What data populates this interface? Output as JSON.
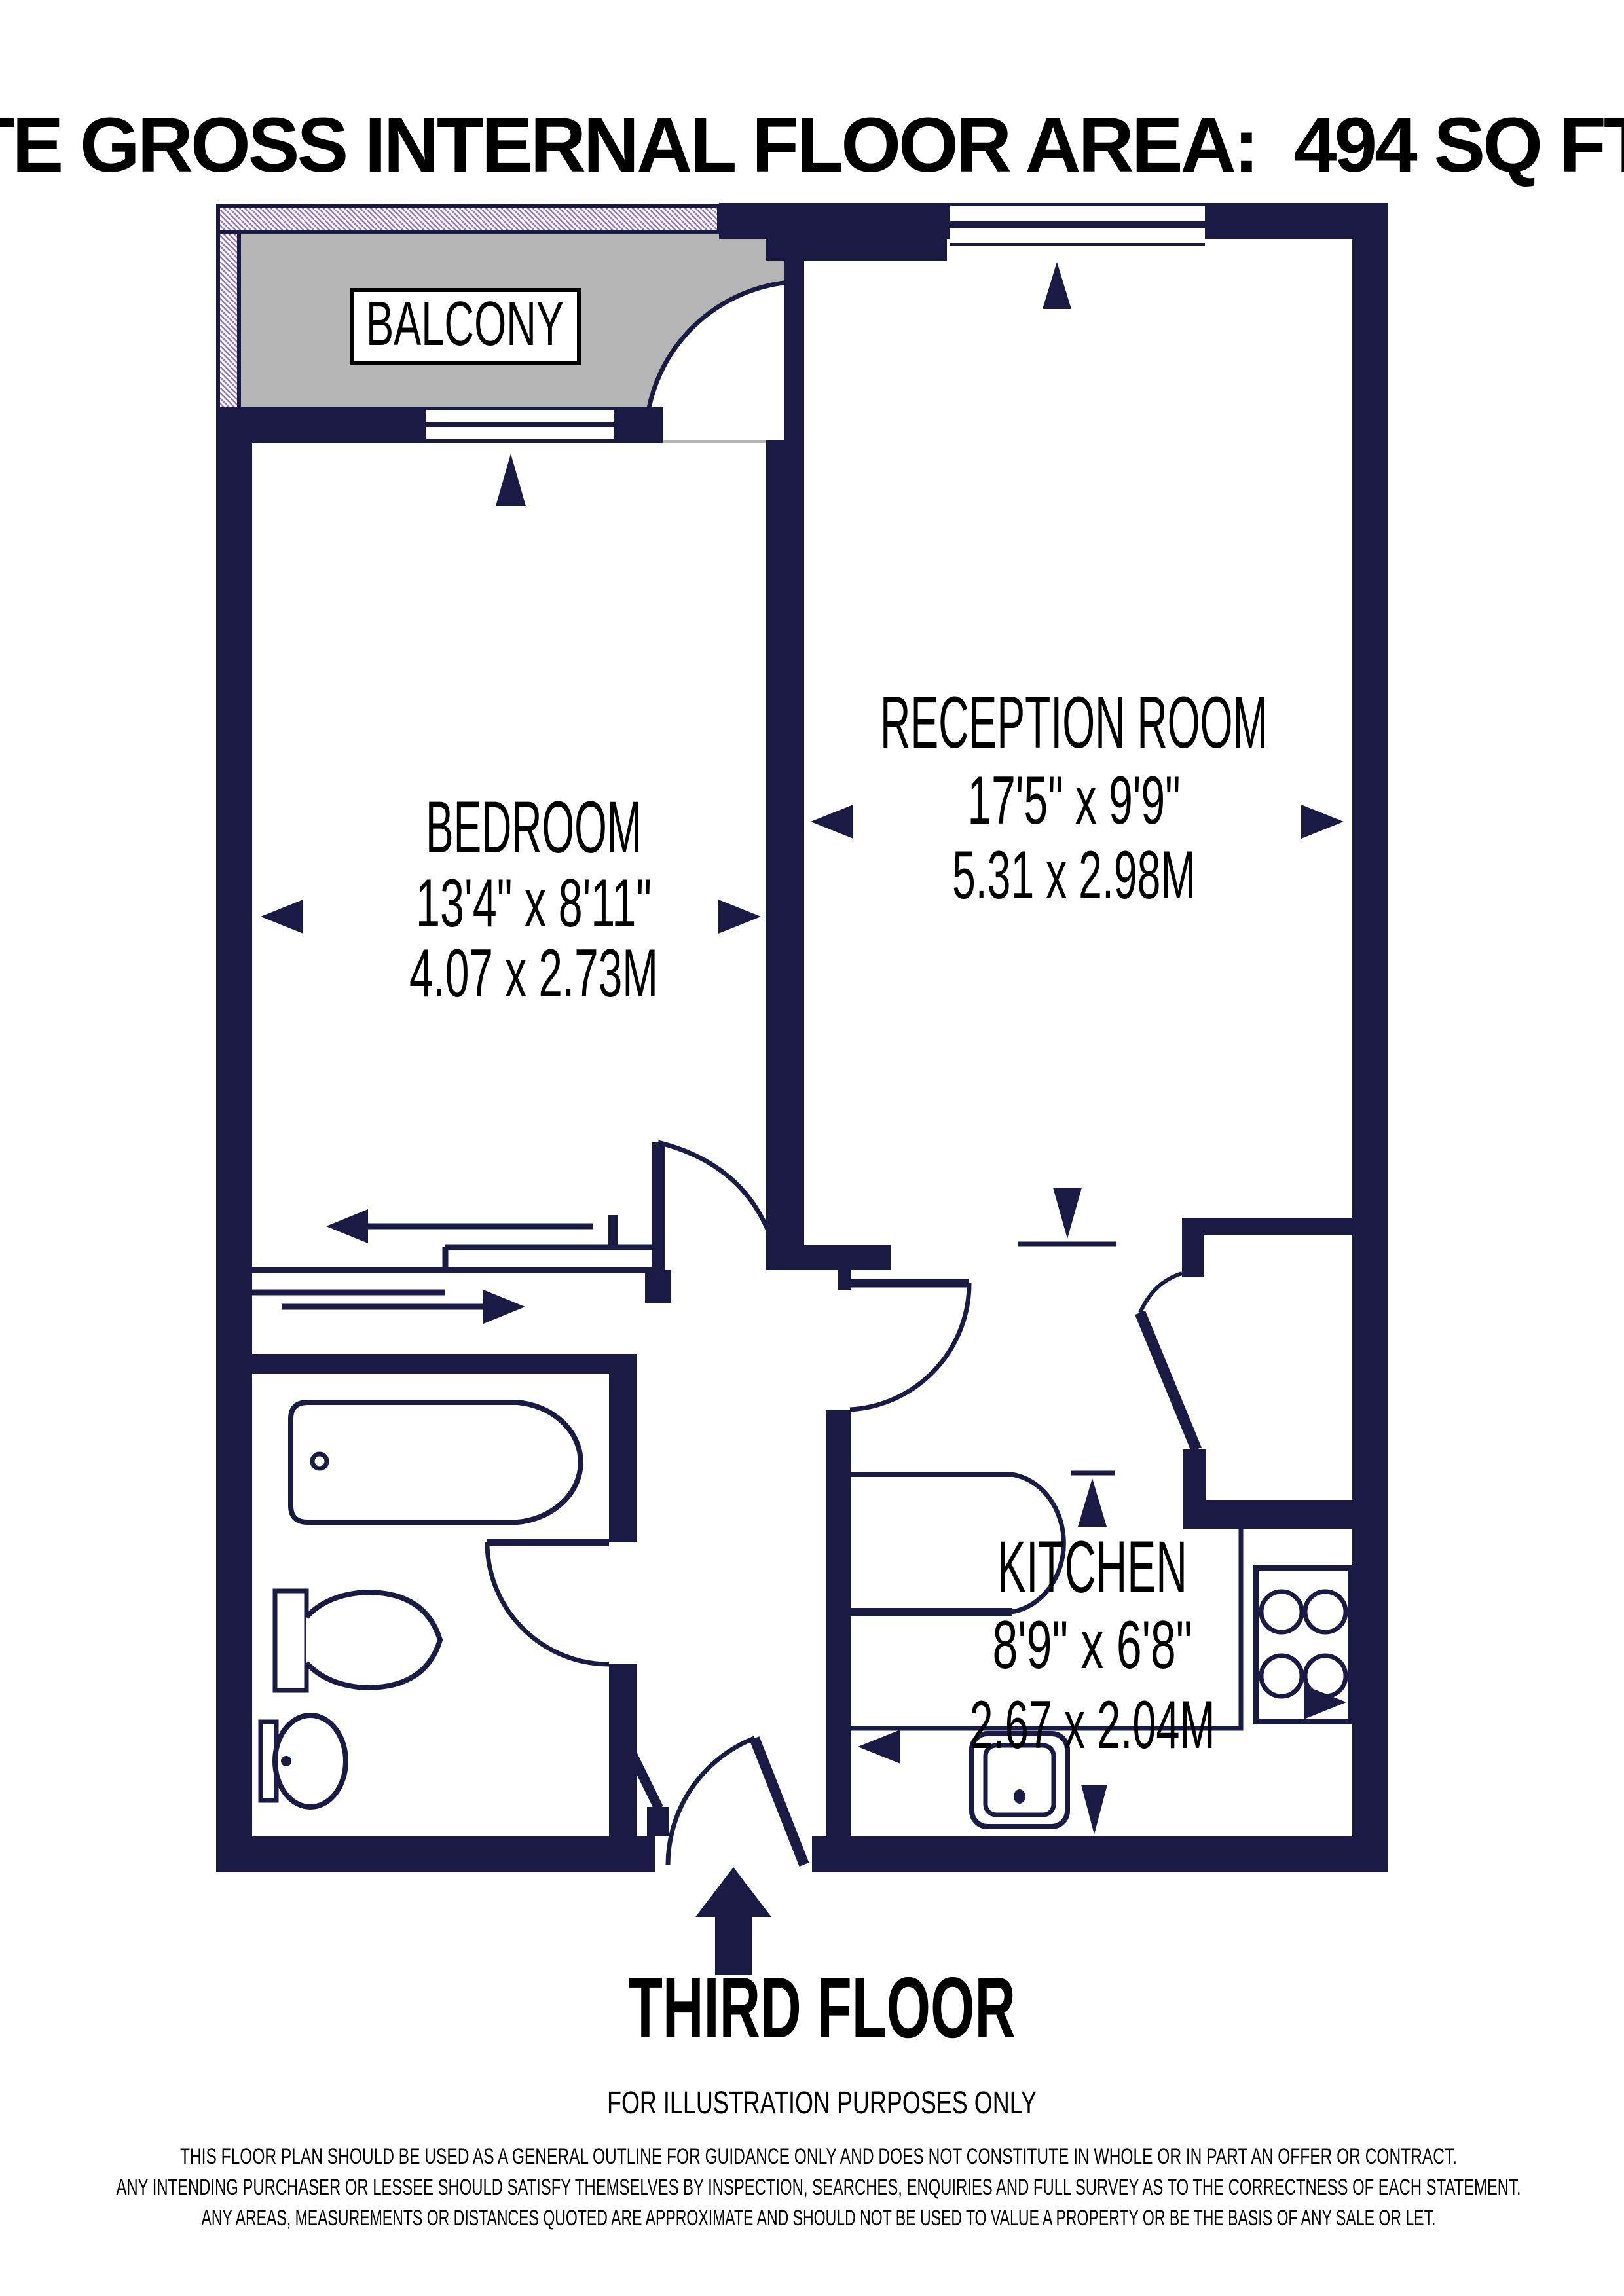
{
  "header": {
    "area_label": "APPROXIMATE GROSS INTERNAL FLOOR AREA:",
    "area_value": "494 SQ FT - 45.94 SQ M"
  },
  "rooms": {
    "balcony": {
      "name": "BALCONY"
    },
    "bedroom": {
      "name": "BEDROOM",
      "imperial": "13'4\" x 8'11\"",
      "metric": "4.07 x 2.73M"
    },
    "reception": {
      "name": "RECEPTION ROOM",
      "imperial": "17'5\" x 9'9\"",
      "metric": "5.31 x 2.98M"
    },
    "kitchen": {
      "name": "KITCHEN",
      "imperial": "8'9\" x 6'8\"",
      "metric": "2.67 x 2.04M"
    }
  },
  "footer": {
    "floor_label": "THIRD FLOOR",
    "illustration_note": "FOR ILLUSTRATION PURPOSES ONLY",
    "disclaimer_lines": [
      "THIS FLOOR PLAN SHOULD BE USED AS A GENERAL OUTLINE FOR GUIDANCE ONLY AND DOES NOT CONSTITUTE IN WHOLE OR IN PART AN OFFER OR CONTRACT.",
      "ANY INTENDING PURCHASER OR LESSEE SHOULD SATISFY THEMSELVES BY INSPECTION, SEARCHES, ENQUIRIES AND FULL SURVEY AS TO THE CORRECTNESS OF EACH STATEMENT.",
      "ANY AREAS, MEASUREMENTS OR DISTANCES QUOTED ARE APPROXIMATE AND SHOULD NOT BE USED TO VALUE A PROPERTY OR BE THE BASIS OF ANY SALE OR LET."
    ]
  },
  "colors": {
    "wall_navy": "#1a1a45",
    "balcony_floor_gray": "#b5b5b5",
    "hatch_purple": "#9a7cc0",
    "text_black": "#000000"
  }
}
